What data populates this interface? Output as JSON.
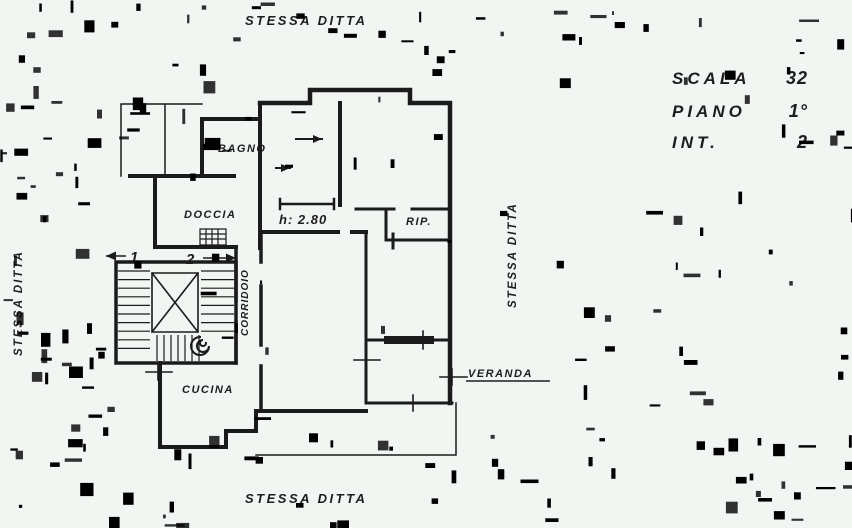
{
  "stamps": {
    "top": "STESSA DITTA",
    "bottom": "STESSA DITTA",
    "left": "STESSA DITTA",
    "right": "STESSA DITTA"
  },
  "info_block": {
    "scala_label": "SCALA",
    "scala_value": "32",
    "piano_label": "PIANO",
    "piano_value": "1°",
    "int_label": "INT.",
    "int_value": "2"
  },
  "rooms": {
    "bagno": "BAGNO",
    "doccia": "DOCCIA",
    "bedroom_height": "h: 2.80",
    "rip": "RIP.",
    "corridoio": "CORRIDOIO",
    "cucina": "CUCINA",
    "veranda": "VERANDA"
  },
  "stairs": {
    "flight_up": "1",
    "flight_down": "2"
  },
  "colors": {
    "ink": "#1b1b1b",
    "paper": "#f2f6f3"
  }
}
